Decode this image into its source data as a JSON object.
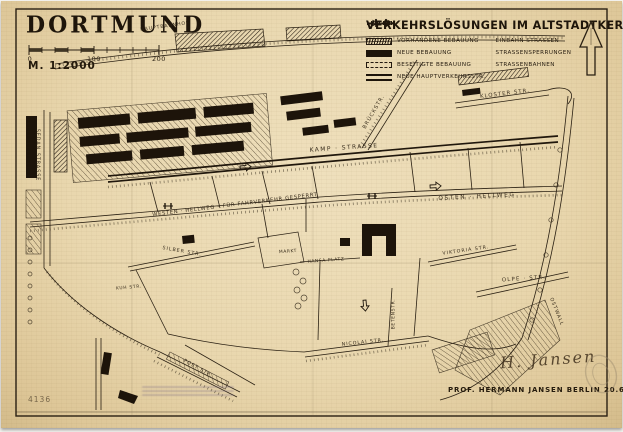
{
  "map": {
    "title": "DORTMUND",
    "scale_label": "M. 1:2000",
    "scale_bar": {
      "ticks": [
        "0",
        "100",
        "200"
      ]
    },
    "legend": {
      "title": "VERKEHRSLÖSUNGEN IM ALTSTADTKERN",
      "items_left": [
        {
          "label": "VORHANDENE BEBAUUNG",
          "swatch": "hatched"
        },
        {
          "label": "NEUE BEBAUUNG",
          "swatch": "solid"
        },
        {
          "label": "BESEITIGTE BEBAUUNG",
          "swatch": "dashed"
        },
        {
          "label": "NEUE HAUPTVERKEHRSSTR.",
          "swatch": "double-line"
        }
      ],
      "items_right": [
        {
          "label": "EINBAHN STRASSEN",
          "swatch": "one-way-arrows"
        },
        {
          "label": "STRASSENSPERRUNGEN",
          "swatch": "barrier"
        },
        {
          "label": "STRASSENBAHNEN",
          "swatch": "tram-line"
        }
      ],
      "north_arrow": "north-arrow"
    },
    "street_labels": [
      {
        "text": "HAUPTBAHNHOF",
        "x": 165,
        "y": 27,
        "angle": -8,
        "size": 4.8,
        "ls": 0.8
      },
      {
        "text": "KLOSTER STR.",
        "x": 505,
        "y": 94,
        "angle": -7,
        "size": 5.4,
        "ls": 1
      },
      {
        "text": "BRÜCKSTR.",
        "x": 374,
        "y": 112,
        "angle": -60,
        "size": 5.2,
        "ls": 1
      },
      {
        "text": "KAMP · STRASSE",
        "x": 344,
        "y": 148,
        "angle": -4,
        "size": 6,
        "ls": 1.4
      },
      {
        "text": "WESTEN · HELLWEG  –  FÜR FAHRVERKEHR GESPERRT",
        "x": 235,
        "y": 205,
        "angle": -7,
        "size": 5.2,
        "ls": 0.7
      },
      {
        "text": "OSTEN · HELLWEG",
        "x": 477,
        "y": 197,
        "angle": -3,
        "size": 5.8,
        "ls": 1.6
      },
      {
        "text": "SILBER STR.",
        "x": 182,
        "y": 252,
        "angle": 10,
        "size": 4.8,
        "ls": 1
      },
      {
        "text": "MARKT",
        "x": 288,
        "y": 252,
        "angle": -4,
        "size": 4.4,
        "ls": 0.6
      },
      {
        "text": "HANSA PLATZ",
        "x": 326,
        "y": 261,
        "angle": -4,
        "size": 4.4,
        "ls": 0.6
      },
      {
        "text": "VIKTORIA STR.",
        "x": 466,
        "y": 251,
        "angle": -8,
        "size": 4.8,
        "ls": 1
      },
      {
        "text": "OLPE · STR.",
        "x": 524,
        "y": 279,
        "angle": -4,
        "size": 5.4,
        "ls": 1.2
      },
      {
        "text": "KUH STR.",
        "x": 129,
        "y": 288,
        "angle": -5,
        "size": 4.4,
        "ls": 0.7
      },
      {
        "text": "NICOLAI STR.",
        "x": 363,
        "y": 343,
        "angle": -6,
        "size": 4.8,
        "ls": 0.9
      },
      {
        "text": "BETENSTR.",
        "x": 394,
        "y": 314,
        "angle": -90,
        "size": 4.4,
        "ls": 0.7
      },
      {
        "text": "POST STR.",
        "x": 198,
        "y": 369,
        "angle": 29,
        "size": 4.8,
        "ls": 0.9
      },
      {
        "text": "SEDAN STRASSE",
        "x": 37,
        "y": 155,
        "angle": 90,
        "size": 4.8,
        "ls": 1
      },
      {
        "text": "OSTWALL",
        "x": 556,
        "y": 312,
        "angle": 68,
        "size": 4.8,
        "ls": 1
      }
    ],
    "credits": {
      "signature": "H. Jansen",
      "attribution": "PROF. HERMANN JANSEN   BERLIN   20.6.38."
    },
    "archive_number": "4136",
    "colors": {
      "paper": "#e9d7ae",
      "ink": "#241a10"
    }
  }
}
